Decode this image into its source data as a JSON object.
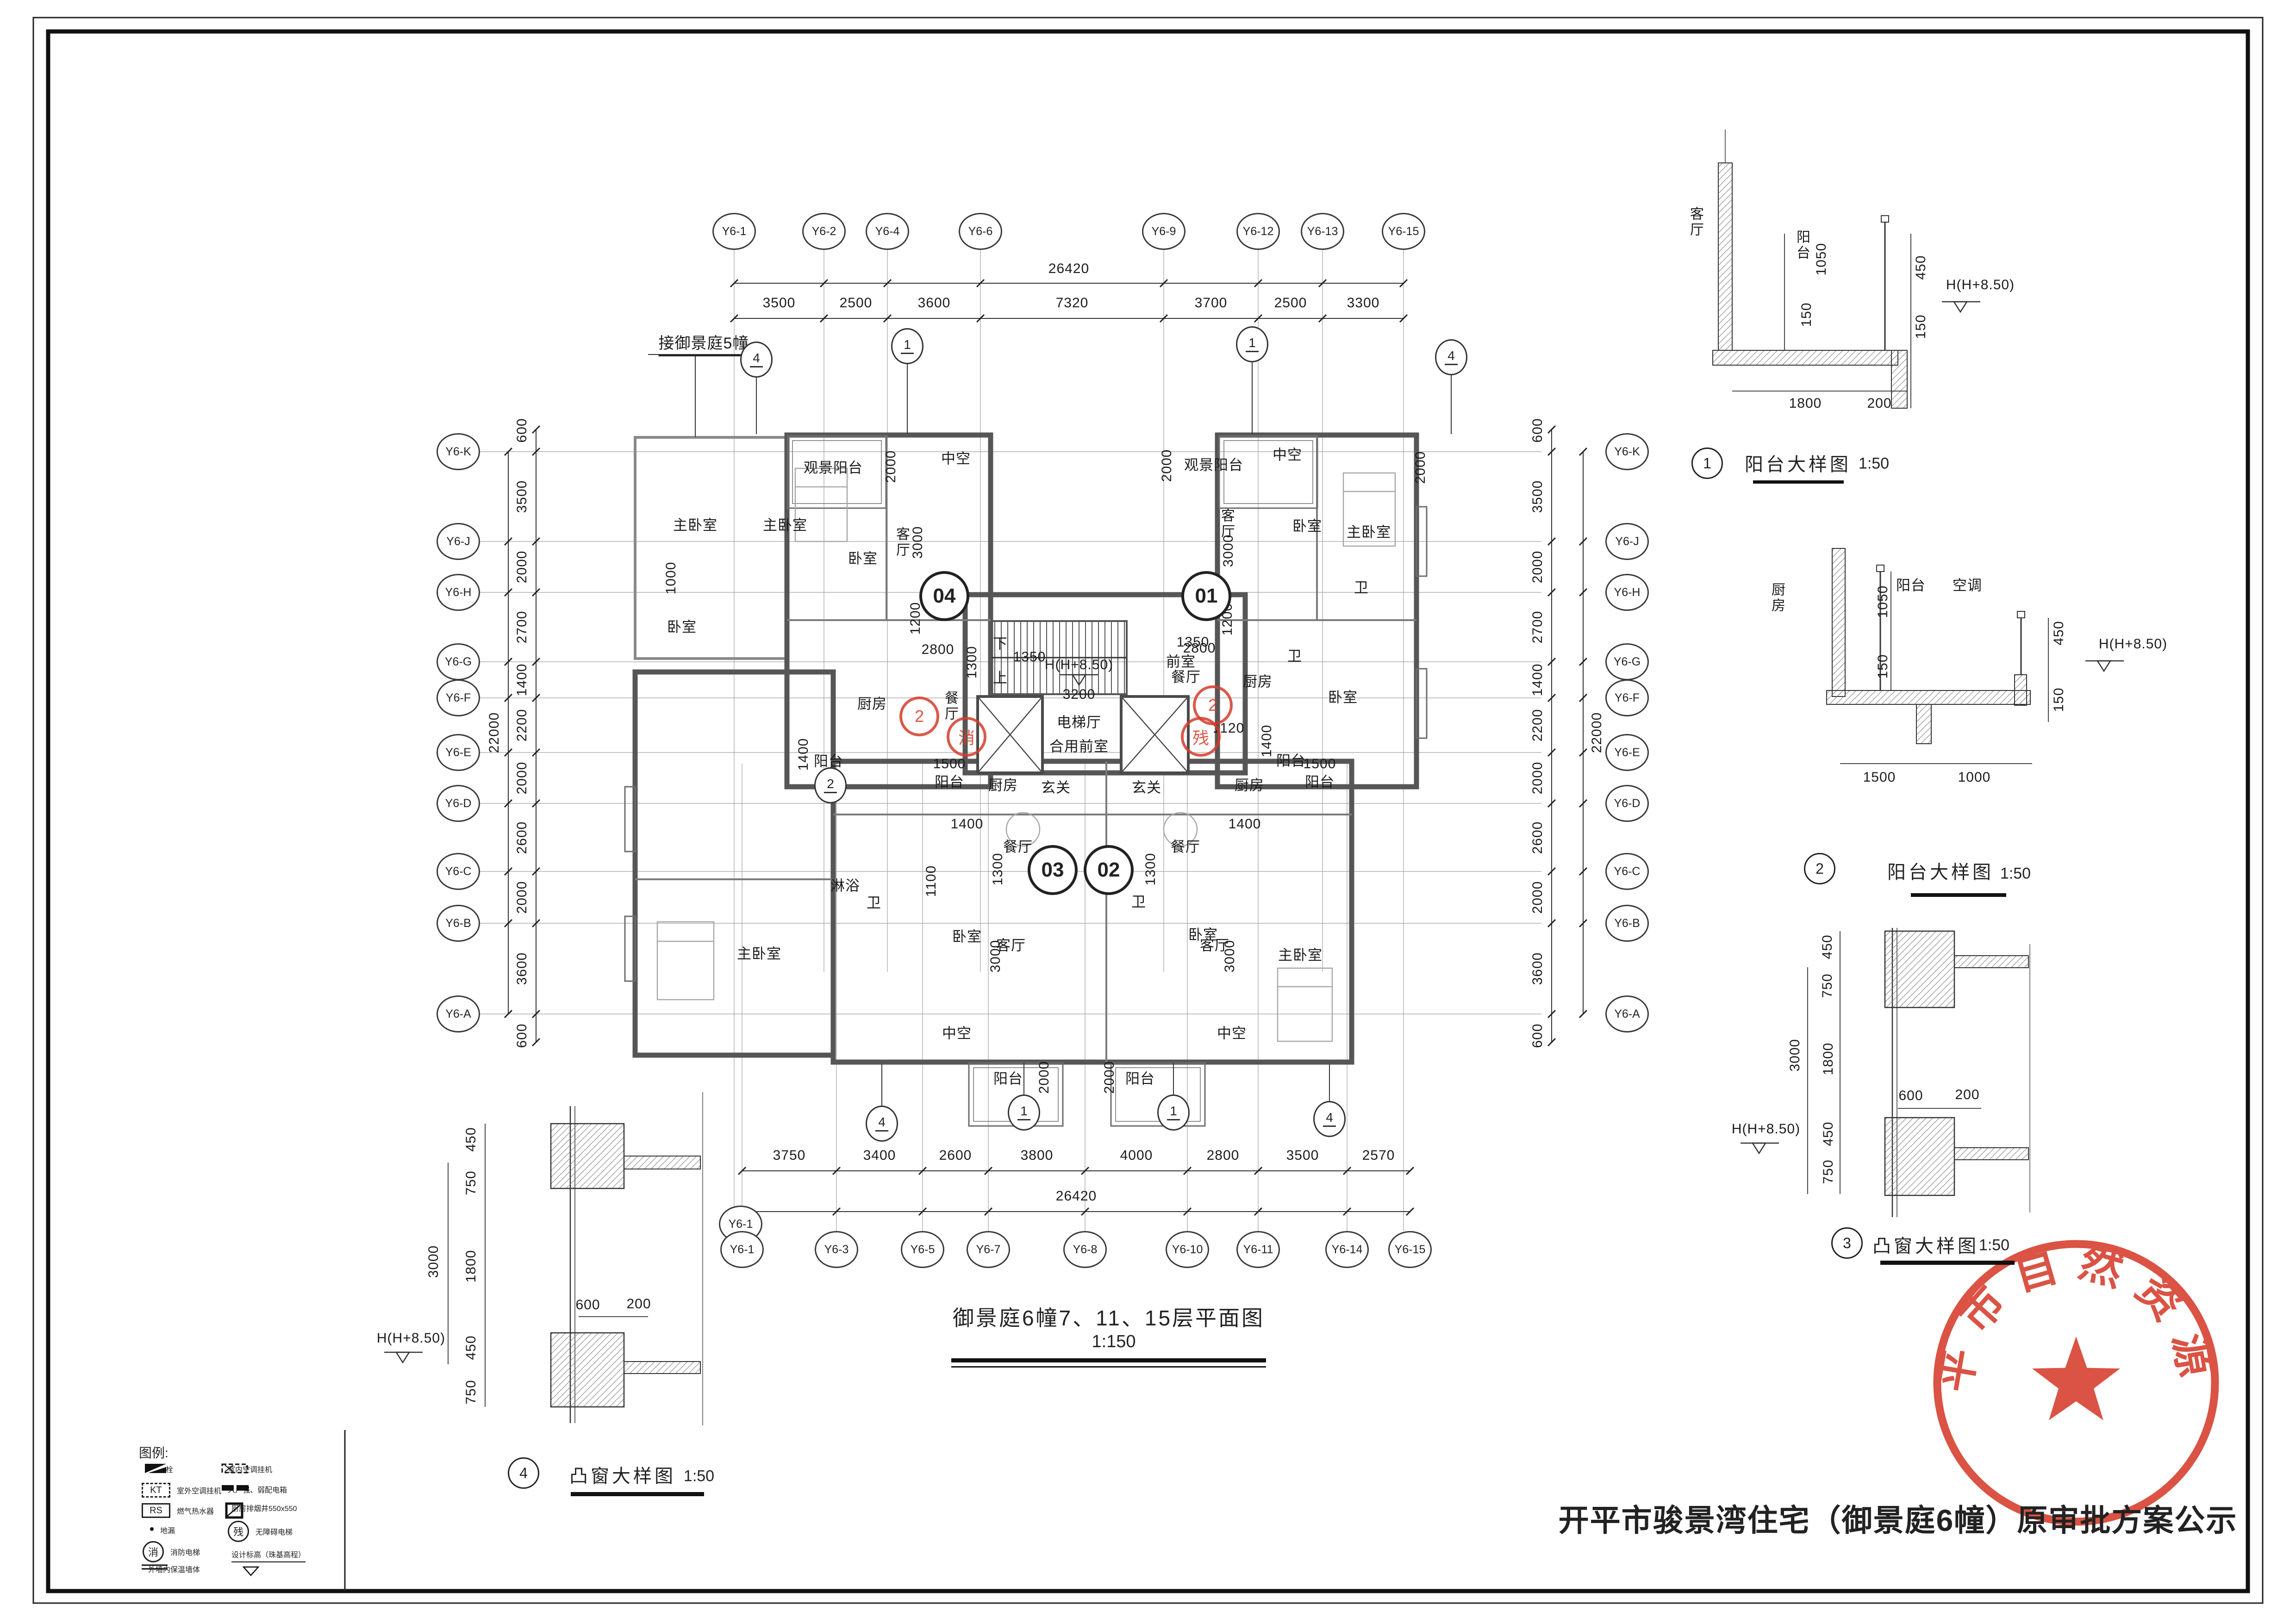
{
  "sheet": {
    "title": "开平市骏景湾住宅（御景庭6幢）原审批方案公示",
    "stamp_agency": "开平市自然资源局"
  },
  "plan": {
    "caption": "御景庭6幢7、11、15层平面图",
    "scale": "1:150",
    "note_adjacent": "接御景庭5幢",
    "axes_top": {
      "labels": [
        "Y6-1",
        "Y6-2",
        "Y6-4",
        "Y6-6",
        "Y6-9",
        "Y6-12",
        "Y6-13",
        "Y6-15"
      ],
      "dims": [
        "3500",
        "2500",
        "3600",
        "7320",
        "3700",
        "2500",
        "3300"
      ],
      "total": "26420"
    },
    "axes_bottom": {
      "labels": [
        "Y6-1",
        "Y6-3",
        "Y6-5",
        "Y6-7",
        "Y6-8",
        "Y6-10",
        "Y6-11",
        "Y6-14",
        "Y6-15"
      ],
      "dims": [
        "3750",
        "3400",
        "2600",
        "3800",
        "4000",
        "2800",
        "3500",
        "2570"
      ],
      "total": "26420"
    },
    "axes_left": {
      "labels": [
        "Y6-K",
        "Y6-J",
        "Y6-H",
        "Y6-G",
        "Y6-F",
        "Y6-E",
        "Y6-D",
        "Y6-C",
        "Y6-B",
        "Y6-A"
      ],
      "dims": [
        "600",
        "3500",
        "2000",
        "2700",
        "1400",
        "2200",
        "2000",
        "2600",
        "2000",
        "3600",
        "600"
      ],
      "total": "22000"
    },
    "axes_right": {
      "labels": [
        "Y6-K",
        "Y6-J",
        "Y6-H",
        "Y6-G",
        "Y6-F",
        "Y6-E",
        "Y6-D",
        "Y6-C",
        "Y6-B",
        "Y6-A"
      ],
      "dims": [
        "600",
        "3500",
        "2000",
        "2700",
        "1400",
        "2200",
        "2000",
        "2600",
        "2000",
        "3600",
        "600"
      ],
      "total": "22000"
    },
    "unit_numbers": [
      "04",
      "01",
      "03",
      "02"
    ],
    "room_labels": [
      "观景阳台",
      "2000",
      "中空",
      "客厅",
      "3000",
      "1200",
      "2800",
      "餐厅",
      "厨房",
      "阳台",
      "1400",
      "主卧室",
      "主卧室",
      "卧室",
      "卧室",
      "1000",
      "观景阳台",
      "2000",
      "中空",
      "客厅",
      "3000",
      "1200",
      "2800",
      "餐厅",
      "厨房",
      "卫",
      "卫",
      "卧室",
      "主卧室",
      "卧室",
      "阳台",
      "1400",
      "2000",
      "下",
      "1350",
      "上",
      "1350",
      "H(H+8.50)",
      "前室",
      "3200",
      "电梯厅",
      "合用前室",
      "1120",
      "1300",
      "1500",
      "阳台",
      "厨房",
      "玄关",
      "玄关",
      "厨房",
      "阳台",
      "1500",
      "餐厅",
      "餐厅",
      "1300",
      "1300",
      "客厅",
      "3000",
      "客厅",
      "3000",
      "卧室",
      "卧室",
      "主卧室",
      "主卧室",
      "淋浴",
      "卫",
      "卫",
      "中空",
      "阳台",
      "2000",
      "阳台",
      "2000",
      "中空",
      "1100",
      "1400",
      "1400"
    ],
    "detail_refs": [
      "4",
      "1",
      "1",
      "4",
      "2",
      "4",
      "1",
      "1",
      "4"
    ],
    "red_refs": [
      "2",
      "2"
    ],
    "elevator_marks": {
      "fire": "消",
      "accessible": "残"
    }
  },
  "details": [
    {
      "no": "1",
      "name": "阳台大样图",
      "scale": "1:50",
      "labels": {
        "room": "客厅",
        "rail": "阳台",
        "h1": "1050",
        "h2": "150",
        "h3": "450",
        "h4": "150",
        "w1": "1800",
        "w2": "200",
        "level": "H(H+8.50)"
      }
    },
    {
      "no": "2",
      "name": "阳台大样图",
      "scale": "1:50",
      "labels": {
        "room": "厨房",
        "rail": "阳台",
        "ac": "空调",
        "h1": "1050",
        "h2": "150",
        "h3": "450",
        "h4": "150",
        "w1": "1500",
        "w2": "1000",
        "level": "H(H+8.50)"
      }
    },
    {
      "no": "3",
      "name": "凸窗大样图",
      "scale": "1:50",
      "labels": {
        "d450a": "450",
        "d750a": "750",
        "d3000": "3000",
        "d1800": "1800",
        "d600": "600",
        "d200": "200",
        "d450b": "450",
        "d750b": "750",
        "level": "H(H+8.50)"
      }
    },
    {
      "no": "4",
      "name": "凸窗大样图",
      "scale": "1:50",
      "labels": {
        "d450a": "450",
        "d750a": "750",
        "d3000": "3000",
        "d1800": "1800",
        "d600": "600",
        "d200": "200",
        "d450b": "450",
        "d750b": "750",
        "level": "H(H+8.50)",
        "axis": "Y6-1"
      }
    }
  ],
  "legend": {
    "title": "图例:",
    "items": [
      {
        "label": "消火栓"
      },
      {
        "label": "室内空调挂机"
      },
      {
        "label": "室外空调挂机",
        "symtext": "KT"
      },
      {
        "label": "入户强、弱配电箱"
      },
      {
        "label": "燃气热水器",
        "symtext": "RS"
      },
      {
        "label": "厨房排烟井550x550"
      },
      {
        "label": "地漏"
      },
      {
        "label": "无障碍电梯",
        "symtext": "残"
      },
      {
        "label": "消防电梯",
        "symtext": "消"
      },
      {
        "label": "设计标高（珠基高程）"
      },
      {
        "label": "外墙内保温墙体"
      }
    ]
  }
}
